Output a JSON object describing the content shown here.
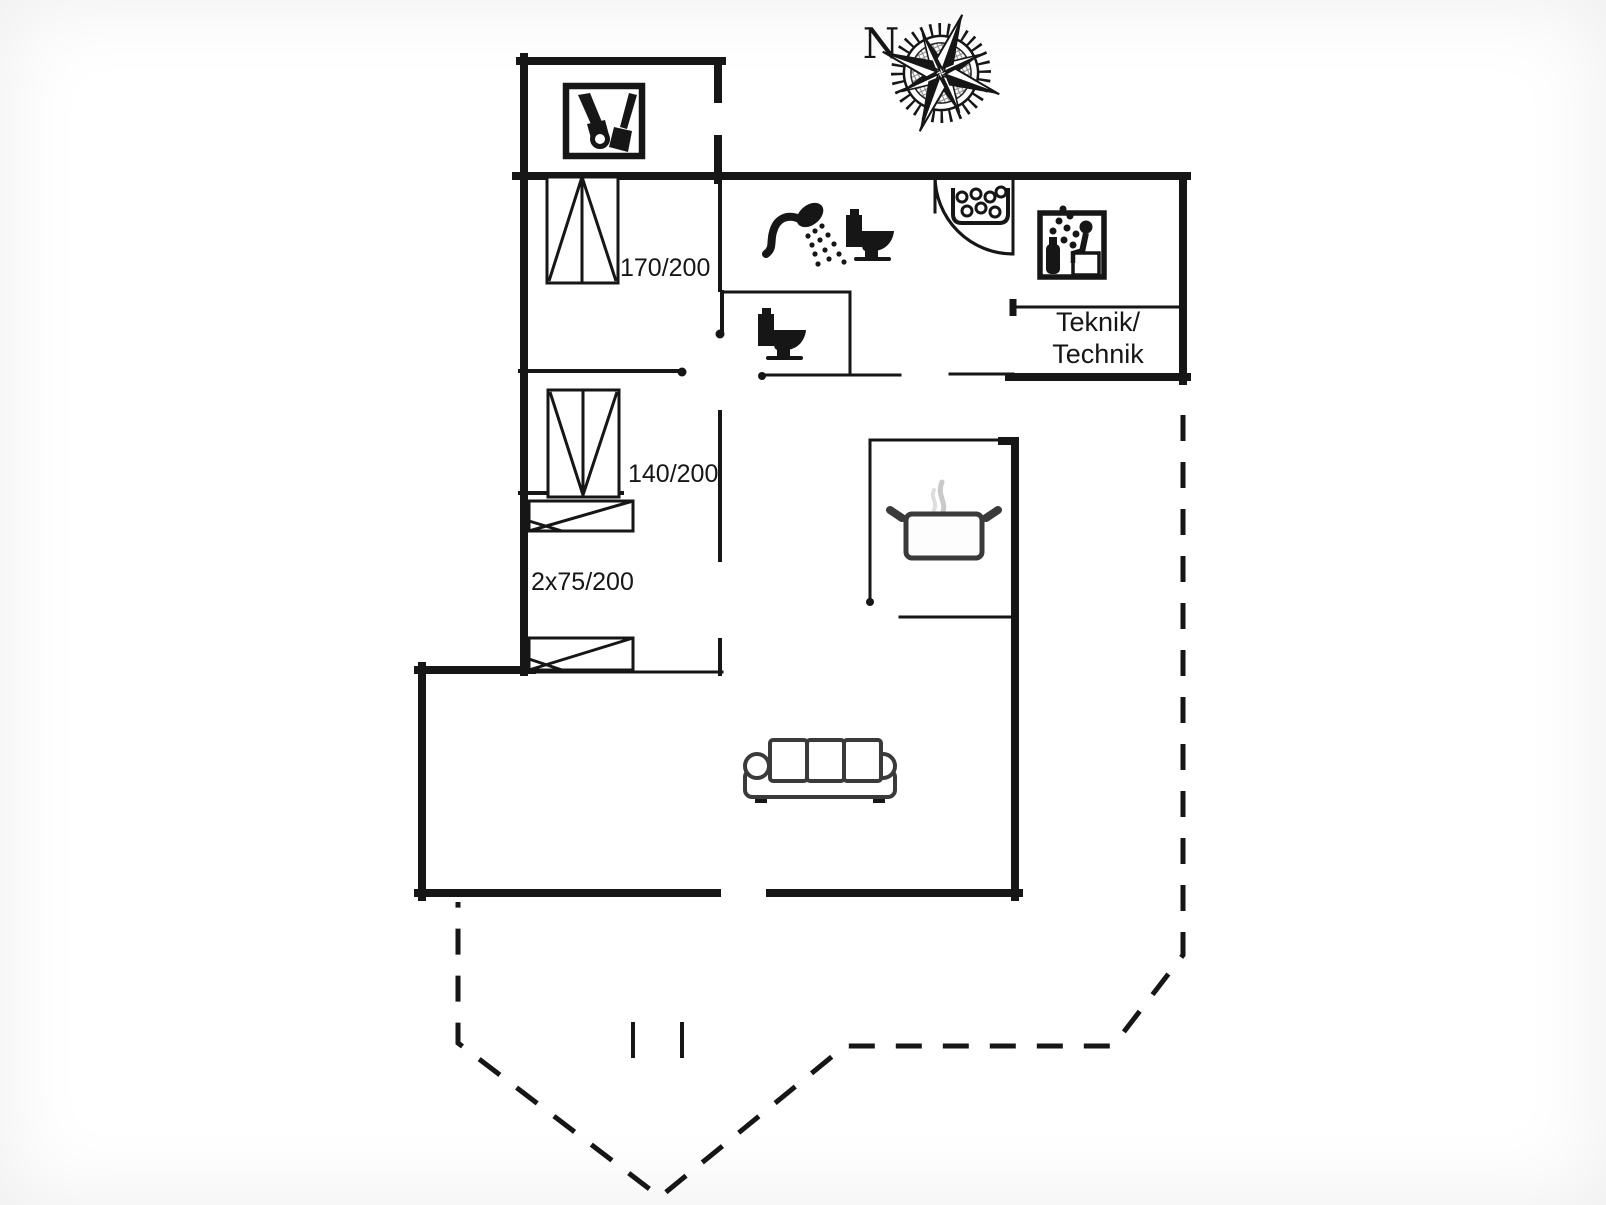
{
  "page": {
    "title": "Floor plan"
  },
  "colors": {
    "ink": "#161616",
    "furniture_outline": "#3a3a3a",
    "steam": "#c9c9c9",
    "background": "#ffffff"
  },
  "compass": {
    "label": "N"
  },
  "rooms": {
    "technical": {
      "label_line1": "Teknik/",
      "label_line2": "Technik"
    }
  },
  "beds": {
    "double_large": {
      "label": "170/200"
    },
    "double_small": {
      "label": "140/200"
    },
    "bunk": {
      "label": "2x75/200"
    }
  },
  "icons": [
    {
      "name": "compass-rose-icon"
    },
    {
      "name": "garden-tools-icon"
    },
    {
      "name": "shower-icon"
    },
    {
      "name": "toilet-icon-bathroom"
    },
    {
      "name": "toilet-icon-wc"
    },
    {
      "name": "sauna-heater-stones-icon"
    },
    {
      "name": "sauna-person-icon"
    },
    {
      "name": "cooking-pot-icon"
    },
    {
      "name": "sofa-icon"
    }
  ]
}
